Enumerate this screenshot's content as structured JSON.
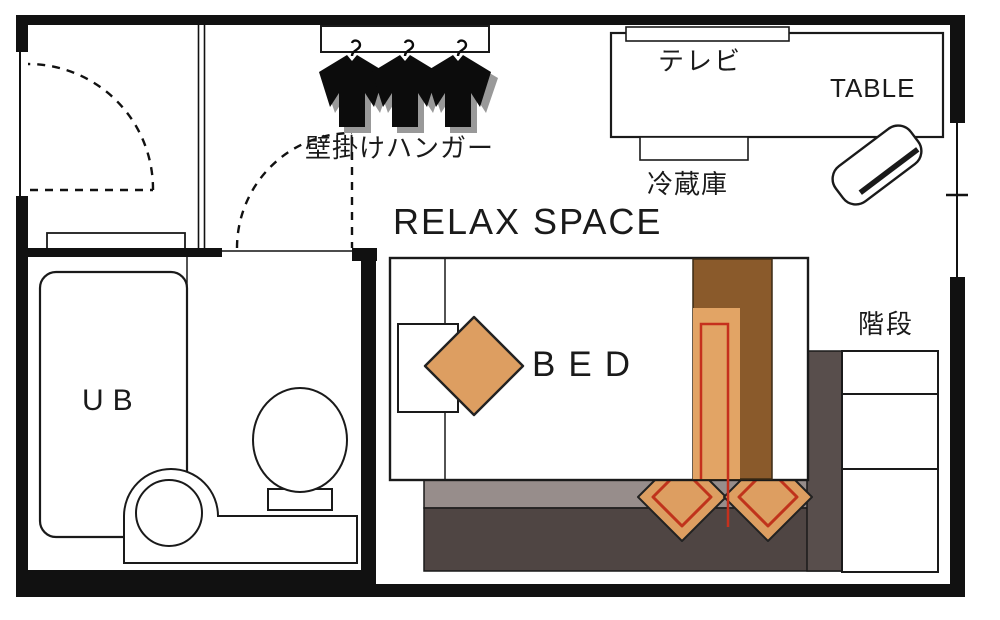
{
  "floorplan": {
    "title": "room-floor-plan",
    "labels": {
      "relax_space": "RELAX SPACE",
      "bed": "BED",
      "unit_bath": "UB",
      "table": "TABLE",
      "tv": "テレビ",
      "refrigerator": "冷蔵庫",
      "stairs": "階段",
      "wall_hanger": "壁掛けハンガー"
    },
    "colors": {
      "wall_black": "#111111",
      "cushion_orange": "#dd9e61",
      "blanket_brown": "#8a5a2b",
      "blanket_orange": "#e2a465",
      "accent_red": "#c5301d",
      "floor_step_light_gray": "#978d8b",
      "floor_step_dark_gray": "#4f4543",
      "stair_landing_gray": "#584e4c",
      "clothes_shadow_gray": "#999999"
    }
  }
}
